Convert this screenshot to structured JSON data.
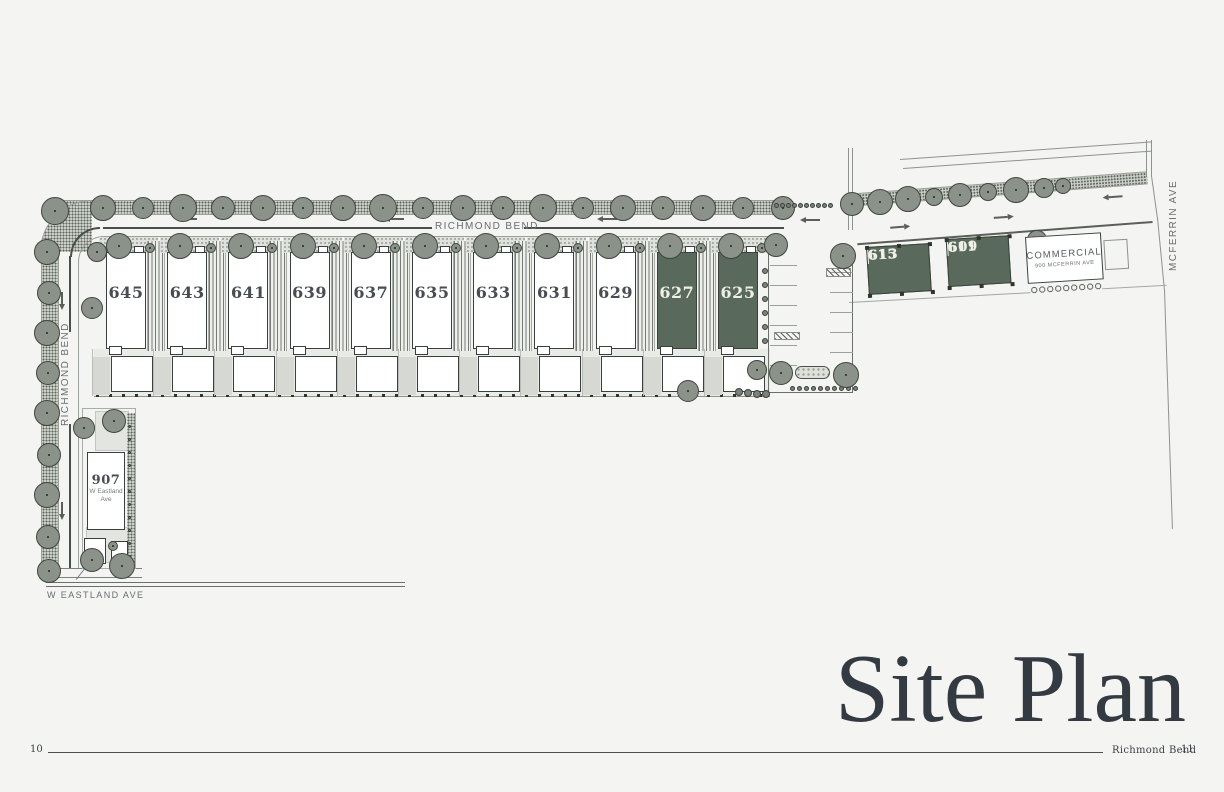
{
  "page": {
    "title": "Site Plan",
    "footer": {
      "page_left": "10",
      "booklet_title": "Richmond Bend",
      "page_right": "11"
    }
  },
  "streets": {
    "richmond_bend_top": "RICHMOND BEND",
    "richmond_bend_left": "RICHMOND BEND",
    "mcferrin": "MCFERRIN AVE",
    "w_eastland": "W EASTLAND AVE"
  },
  "lots": [
    {
      "number": "645",
      "highlighted": false
    },
    {
      "number": "643",
      "highlighted": false
    },
    {
      "number": "641",
      "highlighted": false
    },
    {
      "number": "639",
      "highlighted": false
    },
    {
      "number": "637",
      "highlighted": false
    },
    {
      "number": "635",
      "highlighted": false
    },
    {
      "number": "633",
      "highlighted": false
    },
    {
      "number": "631",
      "highlighted": false
    },
    {
      "number": "629",
      "highlighted": false
    },
    {
      "number": "627",
      "highlighted": true
    },
    {
      "number": "625",
      "highlighted": true
    }
  ],
  "duplexes": [
    {
      "units": [
        "615",
        "613"
      ],
      "highlighted": true
    },
    {
      "units": [
        "611",
        "609"
      ],
      "highlighted": true
    }
  ],
  "commercial": {
    "label": "COMMERCIAL",
    "address": "900 MCFERRIN AVE"
  },
  "eastland_house": {
    "number": "907",
    "street_line1": "W Eastland",
    "street_line2": "Ave"
  },
  "colors": {
    "page_bg": "#f4f4f2",
    "highlight_green": "#59695b",
    "ink": "#3a403f",
    "street_label": "#686d70",
    "title_ink": "#343a41"
  }
}
